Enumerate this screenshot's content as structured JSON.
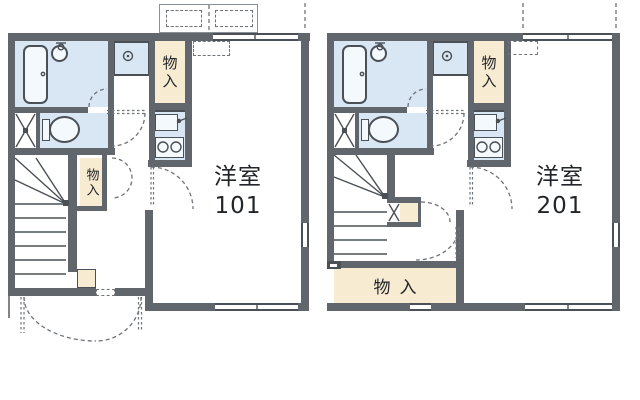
{
  "floorplan": {
    "type": "japanese-apartment-floorplan",
    "colors": {
      "wall": "#61666d",
      "line": "#4a5056",
      "water": "#d9e6f3",
      "fixture": "#f4f9fd",
      "closet": "#f7ebd1",
      "dash": "#6e7378",
      "text": "#222529",
      "bg": "#ffffff"
    },
    "units": [
      {
        "name": "unit-101",
        "room": {
          "type_label": "洋室",
          "number": "101"
        },
        "closets": {
          "upper": "物入",
          "hall": "物入"
        }
      },
      {
        "name": "unit-201",
        "room": {
          "type_label": "洋室",
          "number": "201"
        },
        "closets": {
          "upper": "物入",
          "lower": "物入"
        }
      }
    ]
  }
}
